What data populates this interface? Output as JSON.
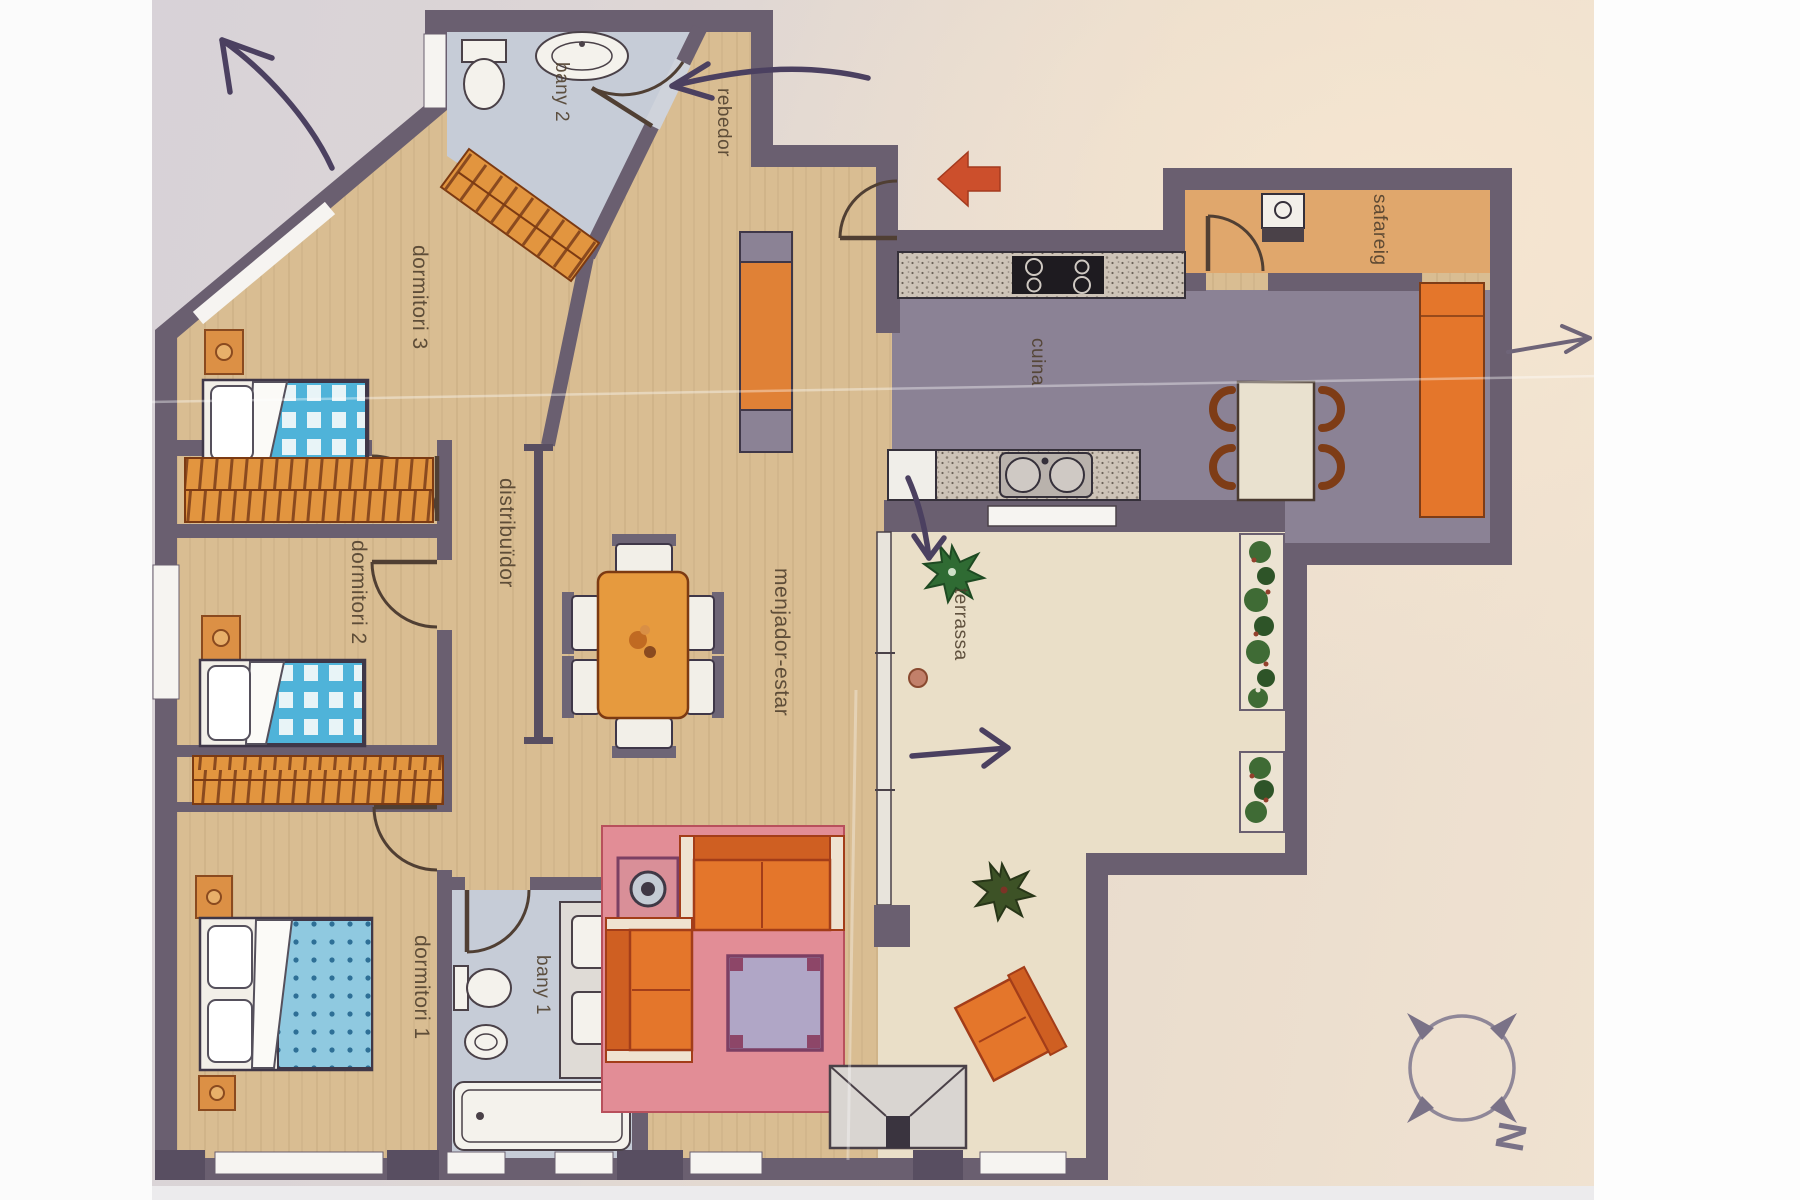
{
  "document": {
    "kind": "scanned apartment floor plan"
  },
  "rooms": {
    "bany2": {
      "label": "bany 2"
    },
    "dormitori3": {
      "label": "dormitori 3"
    },
    "dormitori2": {
      "label": "dormitori 2"
    },
    "dormitori1": {
      "label": "dormitori 1"
    },
    "bany1": {
      "label": "bany 1"
    },
    "distribuidor": {
      "label": "distribuïdor"
    },
    "menjador": {
      "label": "menjador-estar"
    },
    "rebedor": {
      "label": "rebedor"
    },
    "cuina": {
      "label": "cuina"
    },
    "safareig": {
      "label": "safareig"
    },
    "terrassa": {
      "label": "terrassa"
    }
  },
  "compass": {
    "letter": "N"
  },
  "colors": {
    "wall": "#6a5f70",
    "wood_floor": "#d9bd92",
    "bath_floor": "#c6ccd7",
    "kitchen_floor": "#8b8295",
    "laundry_floor": "#e0a76c",
    "terrace_floor": "#eadfc8",
    "furniture_orange": "#e4762b",
    "wardrobe_orange": "#e2953f",
    "rug_pink": "#e28d96",
    "blanket_teal": "#4fb3d9",
    "ink_annotation": "#4b4060",
    "entrance_arrow_red": "#cc4f2c"
  }
}
